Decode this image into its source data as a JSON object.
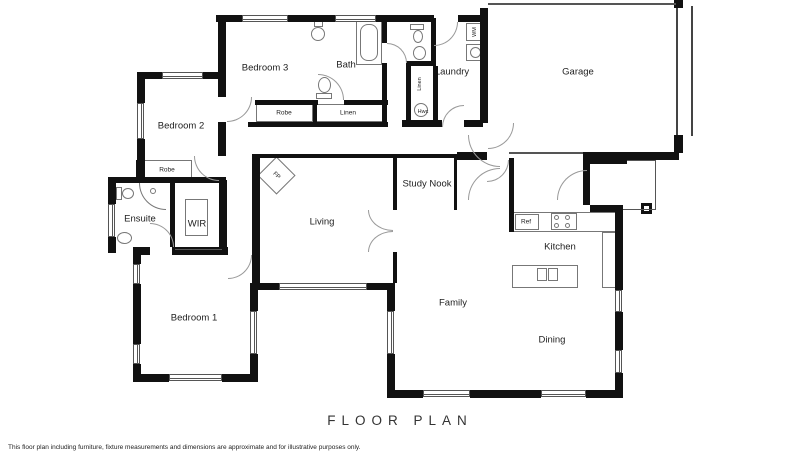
{
  "footer": {
    "title": "FLOOR PLAN",
    "disclaimer": "This floor plan including furniture, fixture measurements and dimensions are approximate and for illustrative purposes only."
  },
  "rooms": {
    "bedroom3": "Bedroom 3",
    "bath": "Bath",
    "laundry": "Laundry",
    "garage": "Garage",
    "bedroom2": "Bedroom 2",
    "study_nook": "Study Nook",
    "ensuite": "Ensuite",
    "wir": "WIR",
    "living": "Living",
    "kitchen": "Kitchen",
    "family": "Family",
    "dining": "Dining",
    "bedroom1": "Bedroom 1"
  },
  "closets": {
    "robe_bedroom2": "Robe",
    "robe_bedroom3": "Robe",
    "linen_hall": "Linen",
    "linen_laundry": "Linen",
    "hot_water_cupboard": "Hwc"
  },
  "fixtures": {
    "washing_machine": "WM",
    "fireplace": "FP",
    "fridge": "Ref"
  },
  "colors": {
    "wall": "#111111",
    "line": "#777777",
    "text": "#222222"
  }
}
